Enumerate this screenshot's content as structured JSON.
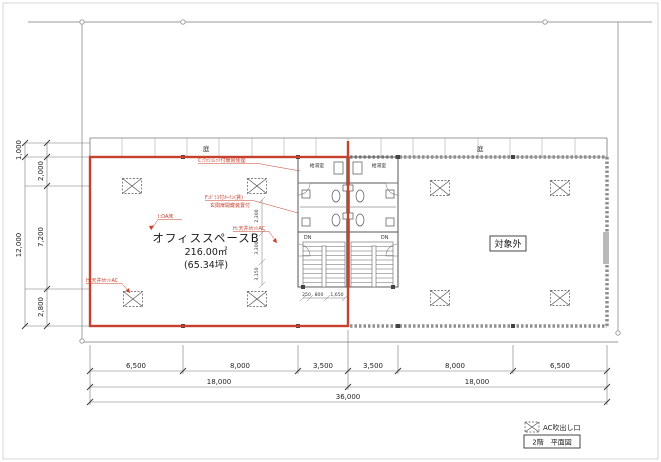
{
  "drawing": {
    "garden_labels": [
      "庭",
      "庭"
    ],
    "office": {
      "name": "オフィススペースB",
      "area": "216.00㎡",
      "tsubo": "(65.34坪)"
    },
    "excluded_label": "対象外",
    "core": {
      "room_left": "給湯室",
      "room_right": "給湯室",
      "dn_left": "DN",
      "dn_right": "DN"
    },
    "annotations": {
      "c": "C:ｳｫｼｭﾚｯﾄ付暖房便座",
      "f1": "F:ｶﾞﾗｽ付ｶｰﾃﾝ(賃)",
      "f2": "玄関扉開鍵装置付",
      "i": "I:OA床",
      "h1": "H:天井ｶｾｯﾄAC",
      "h2": "H:天井ｶｾｯﾄAC"
    }
  },
  "dimensions": {
    "bottom_row1": [
      "6,500",
      "8,000",
      "3,500",
      "3,500",
      "8,000",
      "6,500"
    ],
    "bottom_row2": [
      "18,000",
      "18,000"
    ],
    "bottom_total": "36,000",
    "left_chain": [
      "1,000",
      "2,000",
      "7,200",
      "2,800"
    ],
    "left_total": "12,000",
    "core_vertical": [
      "2,300",
      "3,300",
      "3,150"
    ],
    "stair_chain": [
      "250",
      "800",
      "1,650"
    ]
  },
  "legend": {
    "ac_symbol_label": "AC吹出し口",
    "sheet_title": "2階　平面図"
  },
  "colors": {
    "highlight_red": "#c6402e",
    "wall_gray": "#555555",
    "boundary_gray": "#9a9a9a"
  }
}
